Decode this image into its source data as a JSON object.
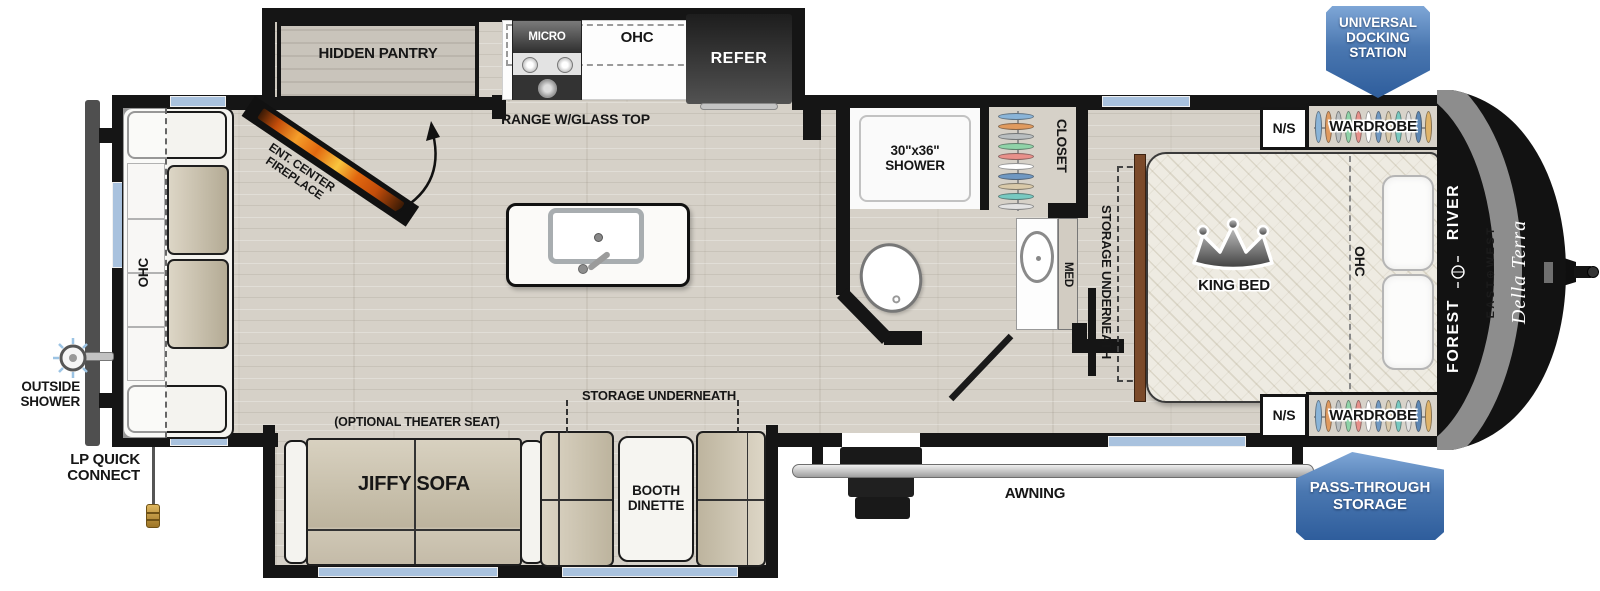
{
  "brand": {
    "forest": "FOREST",
    "river": "RIVER",
    "division": "EAST⊕WEST",
    "model": "Della Terra"
  },
  "badges": {
    "docking_station": "UNIVERSAL DOCKING STATION",
    "pass_through": "PASS-THROUGH STORAGE"
  },
  "exterior": {
    "awning": "AWNING",
    "outside_shower": "OUTSIDE SHOWER",
    "lp_quick_connect": "LP QUICK CONNECT"
  },
  "kitchen": {
    "hidden_pantry": "HIDDEN PANTRY",
    "microwave": "MICRO",
    "overhead_cabinet": "OHC",
    "refrigerator": "REFER",
    "range": "RANGE W/GLASS TOP",
    "fireplace": "ENT. CENTER FIREPLACE"
  },
  "bathroom": {
    "shower": "30\"x36\" SHOWER",
    "closet": "CLOSET",
    "medicine_cabinet": "MED"
  },
  "bedroom": {
    "bed": "KING BED",
    "overhead_cabinet": "OHC",
    "storage": "STORAGE UNDERNEATH",
    "nightstand_top": "N/S",
    "wardrobe_top": "WARDROBE",
    "nightstand_bottom": "N/S",
    "wardrobe_bottom": "WARDROBE"
  },
  "living": {
    "overhead_cabinet": "OHC",
    "sofa": "JIFFY SOFA",
    "sofa_option": "(OPTIONAL THEATER SEAT)",
    "dinette": "BOOTH DINETTE",
    "dinette_storage": "STORAGE UNDERNEATH"
  },
  "colors": {
    "wall": "#151515",
    "window_blue": "#a9c2de",
    "floor_wood": "#d6d1c8",
    "cushion_tan": "#cbc3b0",
    "badge_blue": "#2e5d9c",
    "runner_brown": "#7b4a2a",
    "hangers": [
      "#8ab4d8",
      "#e09a5e",
      "#b9bec0",
      "#8fd3a8",
      "#e8908a",
      "#ffffff",
      "#6f98c2",
      "#d9c9a9",
      "#77c9c1",
      "#e2e2e2",
      "#5d87b5",
      "#e0b46a"
    ]
  }
}
